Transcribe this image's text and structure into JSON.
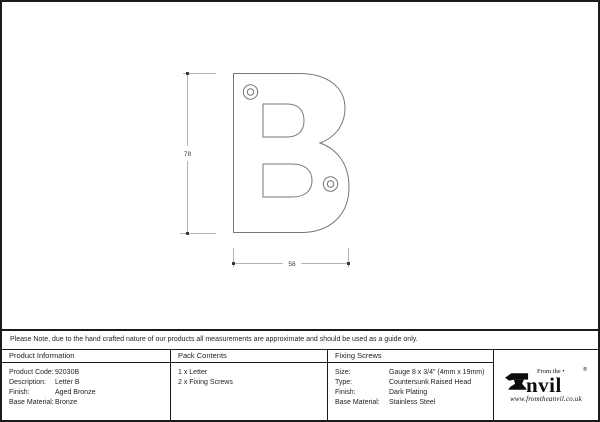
{
  "drawing": {
    "height_dim": "78",
    "width_dim": "58",
    "line_color": "#767676",
    "dim_line_color": "#b4b4b4",
    "tick_color": "#3a3a3a"
  },
  "note": {
    "text": "Please Note, due to the hand crafted nature of our products all measurements are approximate and should be used as a guide only."
  },
  "columns": {
    "product_information": {
      "header": "Product Information",
      "rows": [
        {
          "label": "Product Code:",
          "value": "92030B"
        },
        {
          "label": "Description:",
          "value": "Letter B"
        },
        {
          "label": "Finish:",
          "value": "Aged Bronze"
        },
        {
          "label": "Base Material:",
          "value": "Bronze"
        }
      ]
    },
    "pack_contents": {
      "header": "Pack Contents",
      "items": [
        "1 x Letter",
        "2 x Fixing Screws"
      ]
    },
    "fixing_screws": {
      "header": "Fixing Screws",
      "rows": [
        {
          "label": "Size:",
          "value": "Gauge 8 x 3/4\" (4mm x 19mm)"
        },
        {
          "label": "Type:",
          "value": "Countersunk Raised Head"
        },
        {
          "label": "Finish:",
          "value": "Dark Plating"
        },
        {
          "label": "Base Material:",
          "value": "Stainless Steel"
        }
      ]
    }
  },
  "logo": {
    "tagline": "From the",
    "tagline_dot": "•",
    "wordmark": "nvil",
    "registered": "®",
    "website": "www.fromtheanvil.co.uk"
  }
}
